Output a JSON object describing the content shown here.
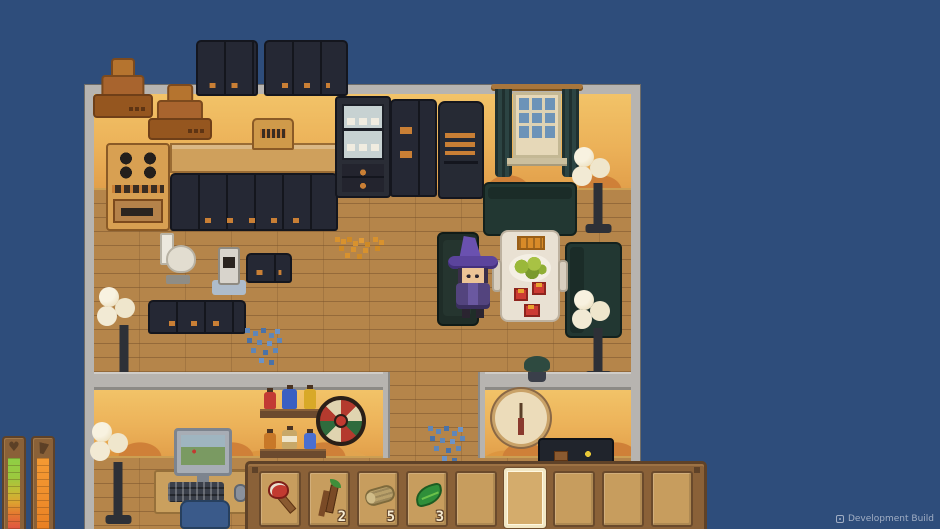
{
  "theme": {
    "bg_blue": "#2e4d7b",
    "wall_gray": "#b7b4b0",
    "wall_wave": "#cf8038",
    "floor_wood": "#b5854a",
    "cabinet_dark": "#252834",
    "handle_orange": "#c97f35",
    "hotbar_frame": "#8a6138",
    "hotbar_frame_dark": "#5f4228",
    "slot_tan": "#c79d5e",
    "selected_cream": "#f2e7c4",
    "count_cream": "#f5ead0",
    "hat_purple": "#6a51b0"
  },
  "hud": {
    "watermark_label": "Development Build",
    "stat_bars": [
      {
        "name": "health",
        "icon": "heart-icon",
        "fill_percent": 100
      },
      {
        "name": "energy",
        "icon": "drink-icon",
        "fill_percent": 100
      }
    ],
    "hotbar": {
      "selected_index": 5,
      "slots": [
        {
          "item": "axe",
          "count": ""
        },
        {
          "item": "branch",
          "count": "2"
        },
        {
          "item": "log",
          "count": "5"
        },
        {
          "item": "leaf",
          "count": "3"
        },
        {
          "item": "",
          "count": ""
        },
        {
          "item": "",
          "count": ""
        },
        {
          "item": "",
          "count": ""
        },
        {
          "item": "",
          "count": ""
        },
        {
          "item": "",
          "count": ""
        }
      ]
    },
    "heart_glyph": "♥"
  }
}
